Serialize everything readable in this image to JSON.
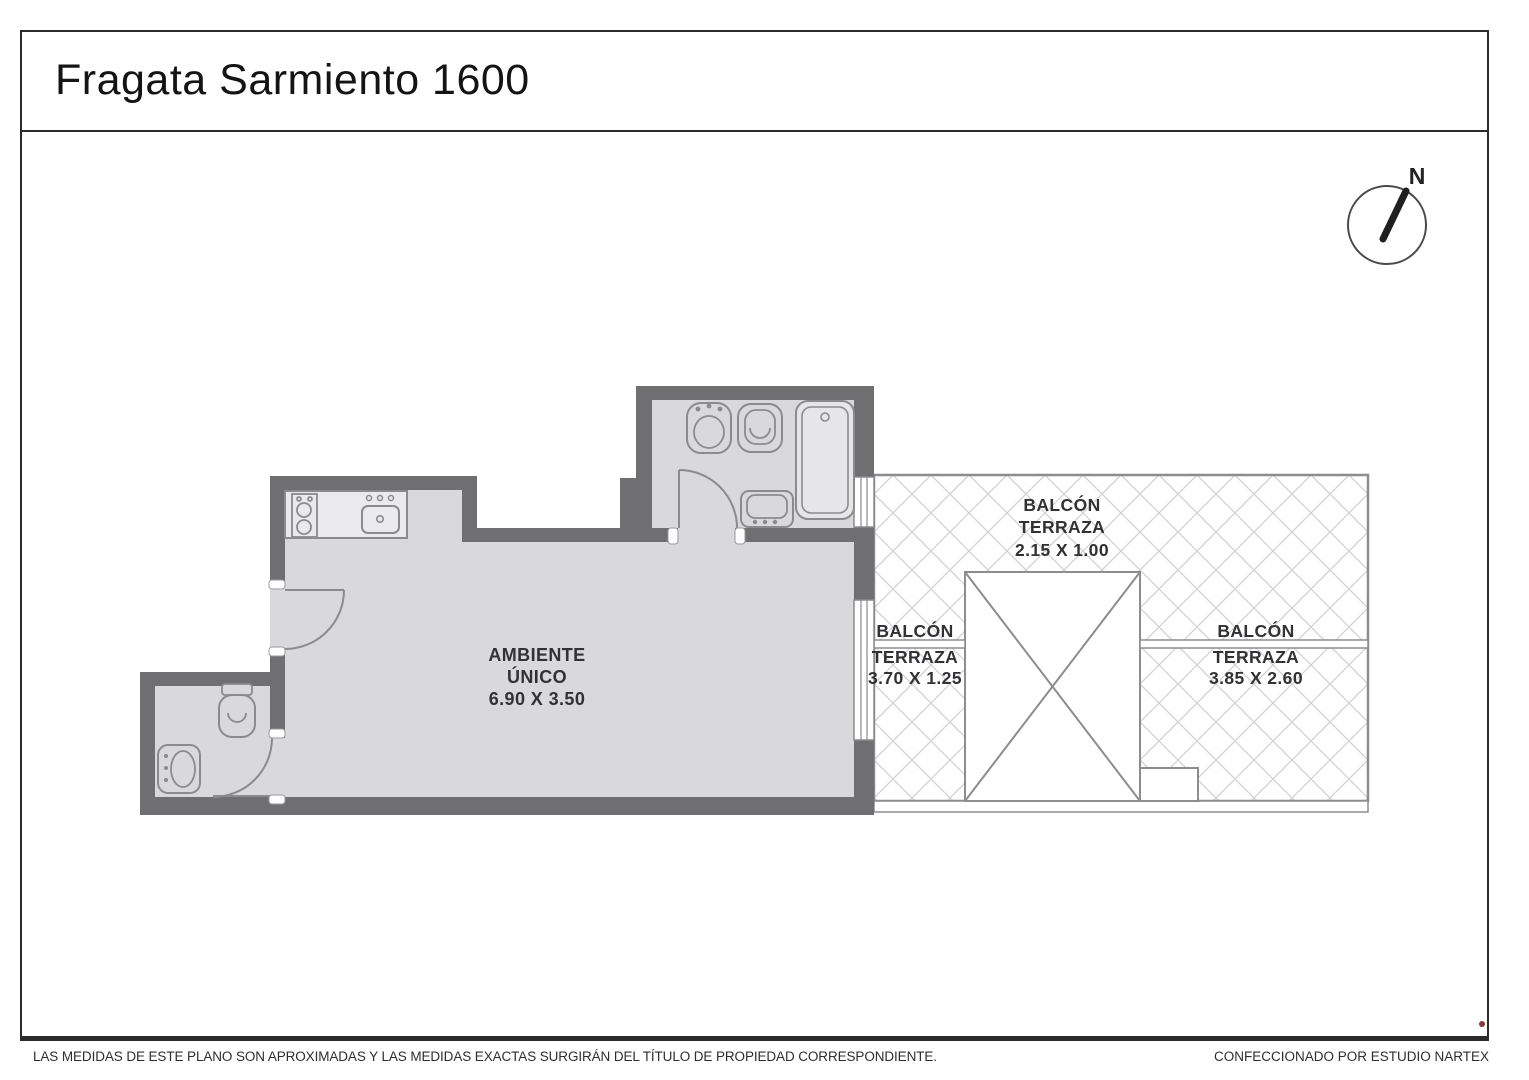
{
  "title": "Fragata Sarmiento 1600",
  "compass": {
    "north_label": "N"
  },
  "plan": {
    "main_room": {
      "line1": "AMBIENTE",
      "line2": "ÚNICO",
      "dims": "6.90 X 3.50"
    },
    "balcony_top": {
      "line1": "BALCÓN",
      "line2": "TERRAZA",
      "dims": "2.15 X 1.00"
    },
    "balcony_left": {
      "line1": "BALCÓN",
      "line2": "TERRAZA",
      "dims": "3.70 X 1.25"
    },
    "balcony_right": {
      "line1": "BALCÓN",
      "line2": "TERRAZA",
      "dims": "3.85 X 2.60"
    }
  },
  "footer": {
    "disclaimer": "LAS MEDIDAS  DE ESTE PLANO SON APROXIMADAS Y LAS MEDIDAS EXACTAS SURGIRÁN DEL TÍTULO DE PROPIEDAD CORRESPONDIENTE.",
    "credit": "CONFECCIONADO POR ESTUDIO NARTEX"
  },
  "colors": {
    "wall": "#6f6f72",
    "floor": "#d9d9db",
    "counter": "#eaeaec",
    "fixture_stroke": "#8b8b8e",
    "hatch_line": "#d2d2d5",
    "frame": "#2b2b2b",
    "accent_dot": "#8a3b30"
  }
}
